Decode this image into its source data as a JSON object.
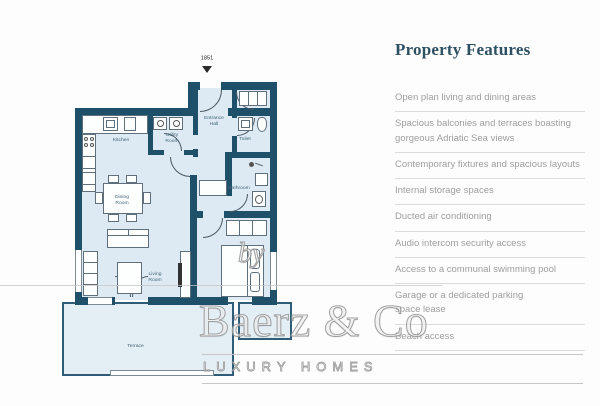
{
  "plan": {
    "entrance_number": "1851",
    "labels": {
      "entrance": "Entrance\nHall",
      "kitchen": "Kitchen",
      "utility": "Utility\nRoom",
      "toilet": "Toilet",
      "bathroom": "Bathroom",
      "dining": "Dining\nRoom",
      "living": "Living\nRoom",
      "terrace": "Terrace"
    }
  },
  "watermark": {
    "by": "by",
    "name": "Baerz & Co",
    "tagline": "LUXURY HOMES"
  },
  "features": {
    "title": "Property Features",
    "items": [
      "Open plan living and dining areas",
      "Spacious balconies and terraces boasting\ngorgeous Adriatic Sea views",
      "Contemporary fixtures and spacious layouts",
      "Internal storage spaces",
      "Ducted air conditioning",
      "Audio intercom security access",
      "Access to a communal swimming pool",
      "Garage or a dedicated parking\nspace lease",
      "Beach access"
    ]
  },
  "colors": {
    "wall": "#1f506a",
    "room_fill": "#ddeaf3",
    "heading": "#2d5163",
    "feature_text": "#9e9e9e"
  }
}
